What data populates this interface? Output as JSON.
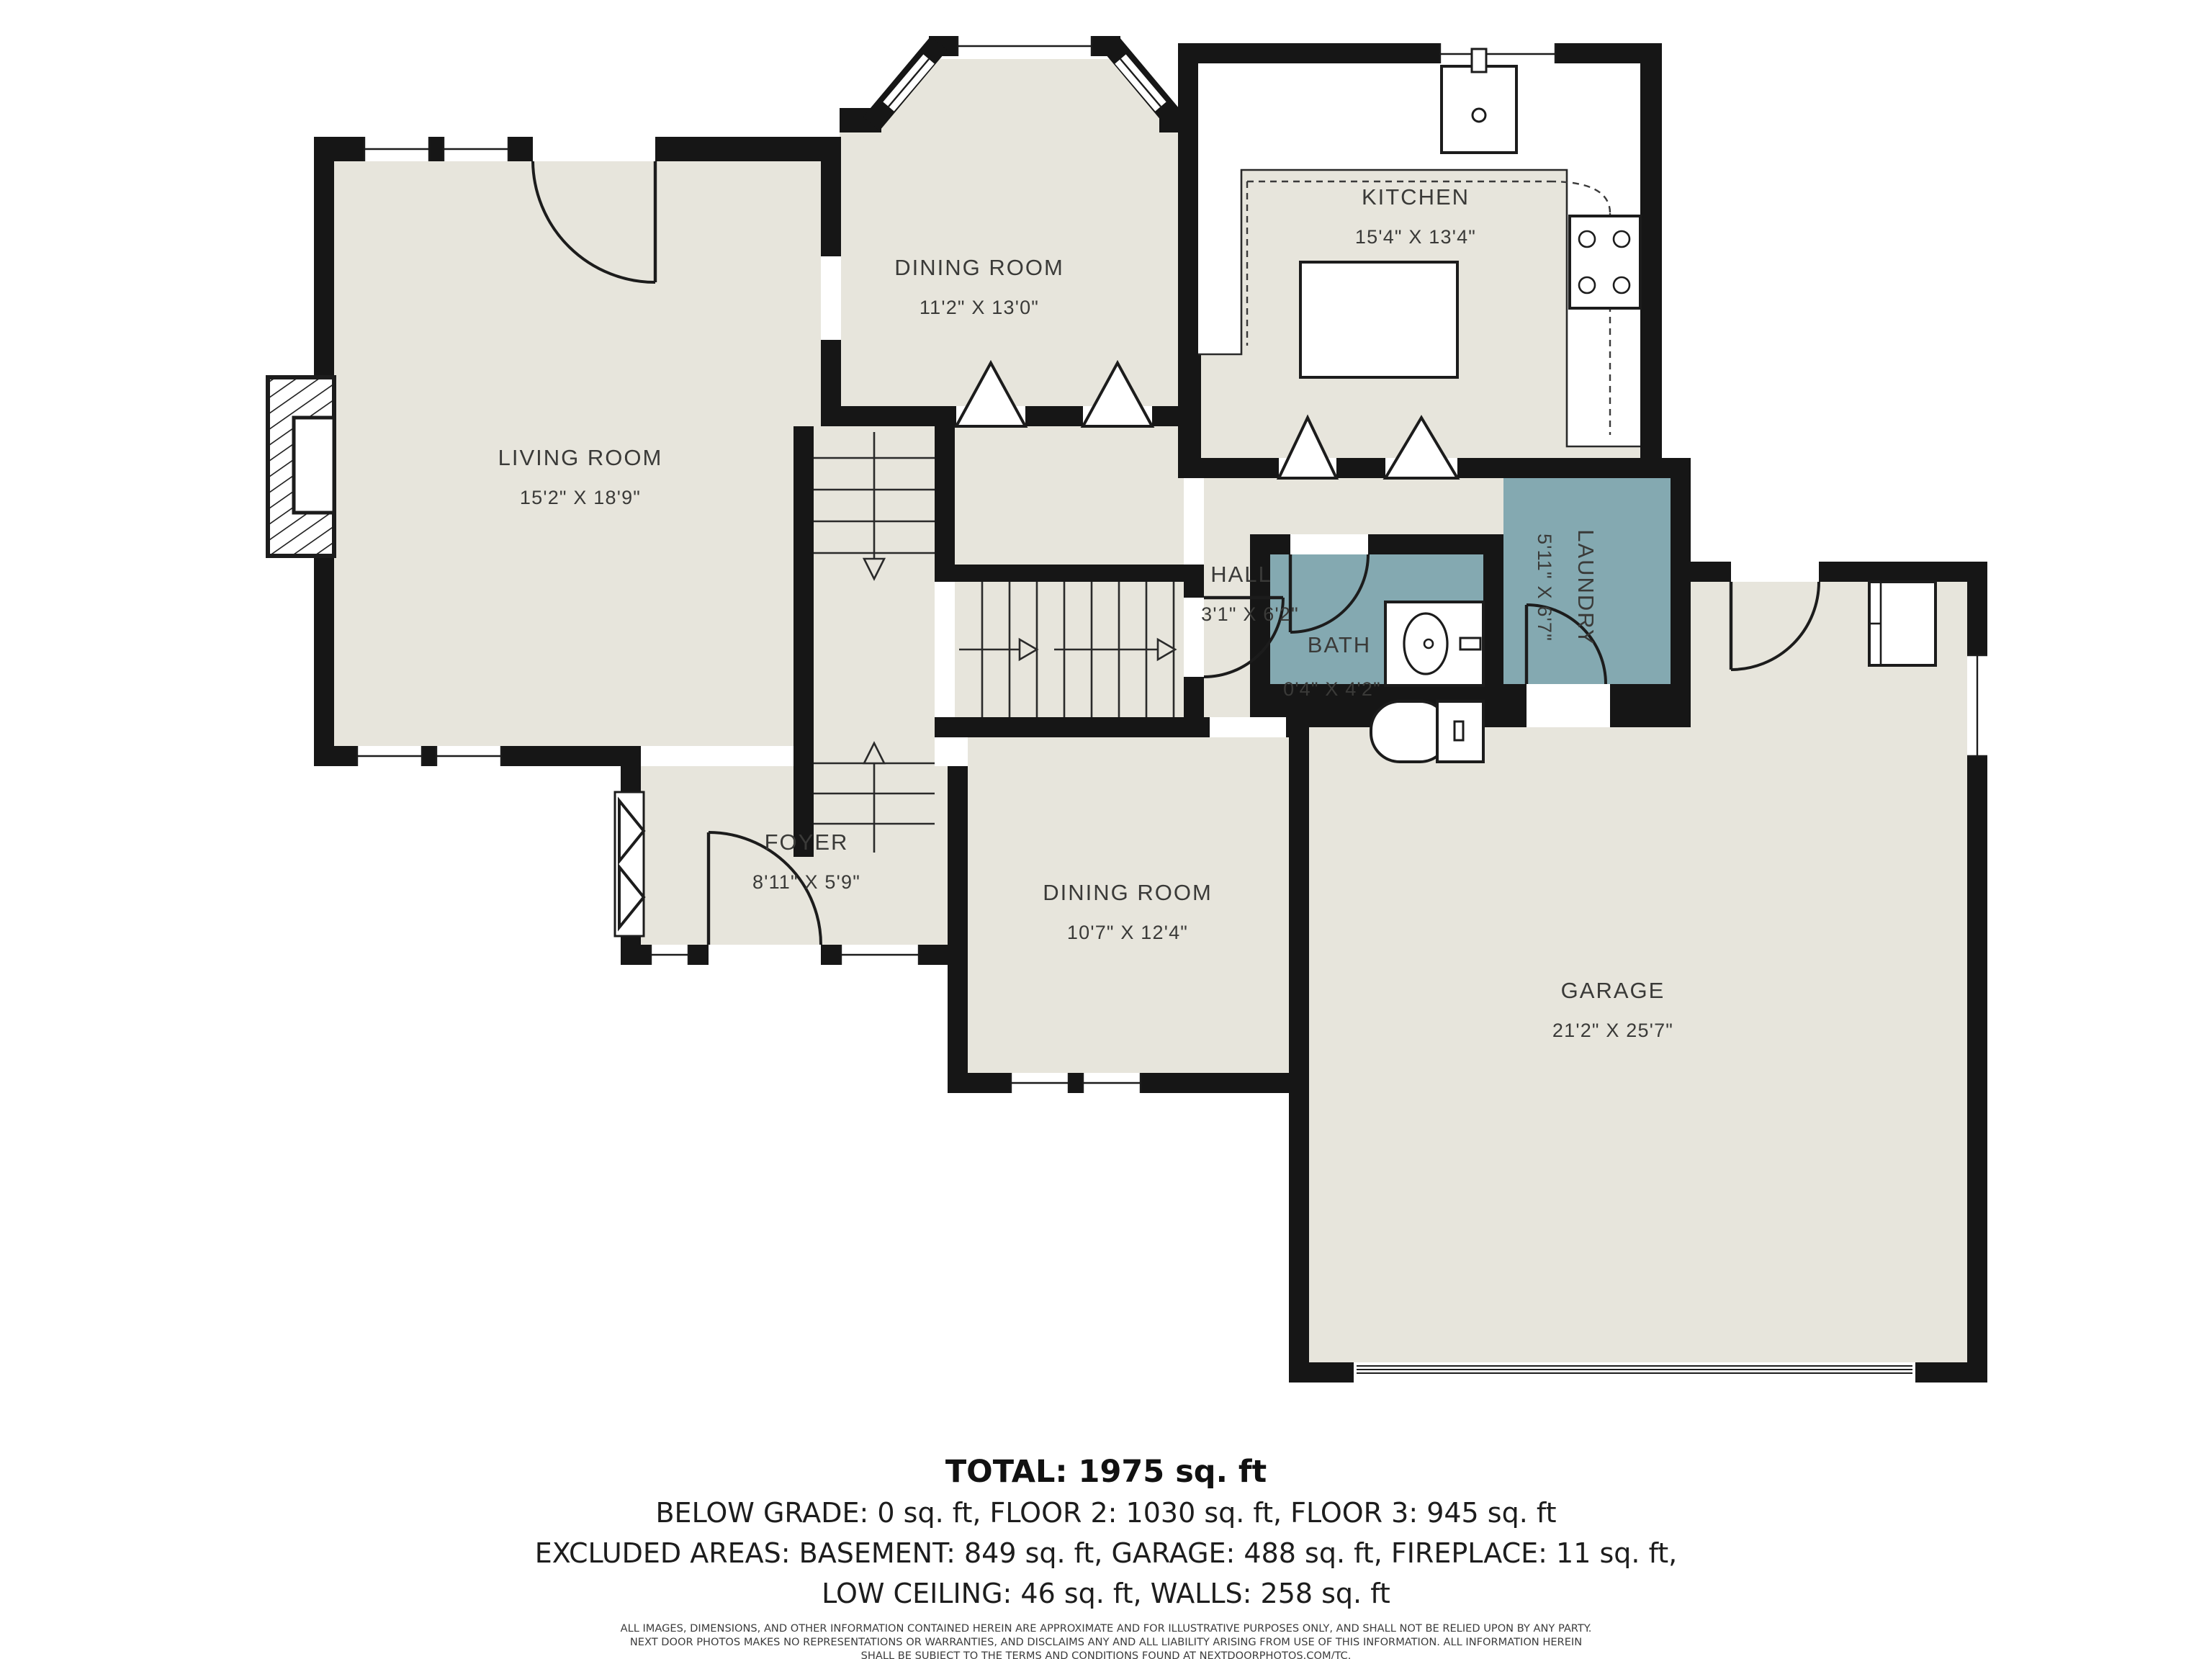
{
  "rooms": {
    "living": {
      "label": "LIVING ROOM",
      "dims": "15'2\" X 18'9\""
    },
    "dining_upper": {
      "label": "DINING ROOM",
      "dims": "11'2\" X 13'0\""
    },
    "kitchen": {
      "label": "KITCHEN",
      "dims": "15'4\" X 13'4\""
    },
    "hall": {
      "label": "HALL",
      "dims": "3'1\" X 6'2\""
    },
    "bath": {
      "label": "BATH",
      "dims": "0'4\" X 4'2\""
    },
    "laundry": {
      "label": "LAUNDRY",
      "dims": "5'11\" X 6'7\""
    },
    "foyer": {
      "label": "FOYER",
      "dims": "8'11\" X 5'9\""
    },
    "dining_lower": {
      "label": "DINING ROOM",
      "dims": "10'7\" X 12'4\""
    },
    "garage": {
      "label": "GARAGE",
      "dims": "21'2\" X 25'7\""
    }
  },
  "summary": {
    "total": "TOTAL: 1975 sq. ft",
    "floors": "BELOW GRADE: 0 sq. ft, FLOOR 2: 1030 sq. ft, FLOOR 3: 945 sq. ft",
    "excluded": "EXCLUDED AREAS: BASEMENT: 849 sq. ft, GARAGE: 488 sq. ft, FIREPLACE: 11 sq. ft,",
    "low_ceiling": "LOW CEILING: 46 sq. ft, WALLS: 258 sq. ft"
  },
  "disclaimer": {
    "line1": "ALL IMAGES, DIMENSIONS, AND OTHER INFORMATION CONTAINED HEREIN ARE APPROXIMATE AND FOR ILLUSTRATIVE PURPOSES ONLY, AND SHALL NOT BE RELIED UPON BY ANY PARTY.",
    "line2": "NEXT DOOR PHOTOS MAKES NO REPRESENTATIONS OR WARRANTIES, AND DISCLAIMS ANY AND ALL LIABILITY ARISING FROM USE OF THIS INFORMATION. ALL INFORMATION HEREIN",
    "line3": "SHALL BE SUBJECT TO THE TERMS AND CONDITIONS FOUND AT NEXTDOORPHOTOS.COM/TC."
  },
  "colors": {
    "background": "#ffffff",
    "floor": "#e7e5dc",
    "wall": "#161616",
    "wet_room": "#84a9b1",
    "label_text": "#3a3a38"
  }
}
